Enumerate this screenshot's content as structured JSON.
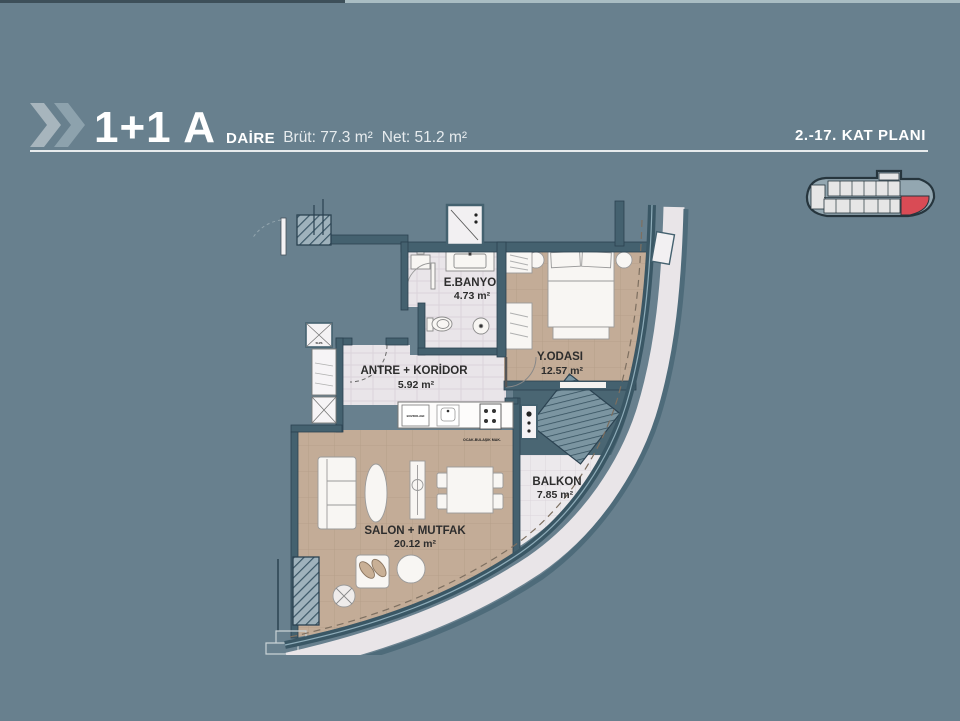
{
  "colors": {
    "background": "#68808e",
    "wall": "#44616f",
    "accent_red": "#d94b55",
    "floor_tan": "#c3ac97",
    "floor_light": "#e9e5e9",
    "header_text": "#ffffff"
  },
  "header": {
    "title": "1+1 A",
    "unit_type_label": "DAİRE",
    "gross_area": "Brüt: 77.3 m²",
    "net_area": "Net: 51.2 m²",
    "plan_range_label": "2.-17. KAT PLANI"
  },
  "floor_plan": {
    "rooms": [
      {
        "name": "E.BANYO",
        "area": "4.73 m²"
      },
      {
        "name": "Y.ODASI",
        "area": "12.57 m²"
      },
      {
        "name": "ANTRE + KORİDOR",
        "area": "5.92 m²"
      },
      {
        "name": "SALON + MUTFAK",
        "area": "20.12 m²"
      },
      {
        "name": "BALKON",
        "area": "7.85 m²"
      }
    ],
    "appliance_labels": {
      "fridge": "BUZDOLABI",
      "stove_dishwasher": "OCAK-BULAŞIK MAK."
    },
    "shaft_label": "SU/S"
  }
}
